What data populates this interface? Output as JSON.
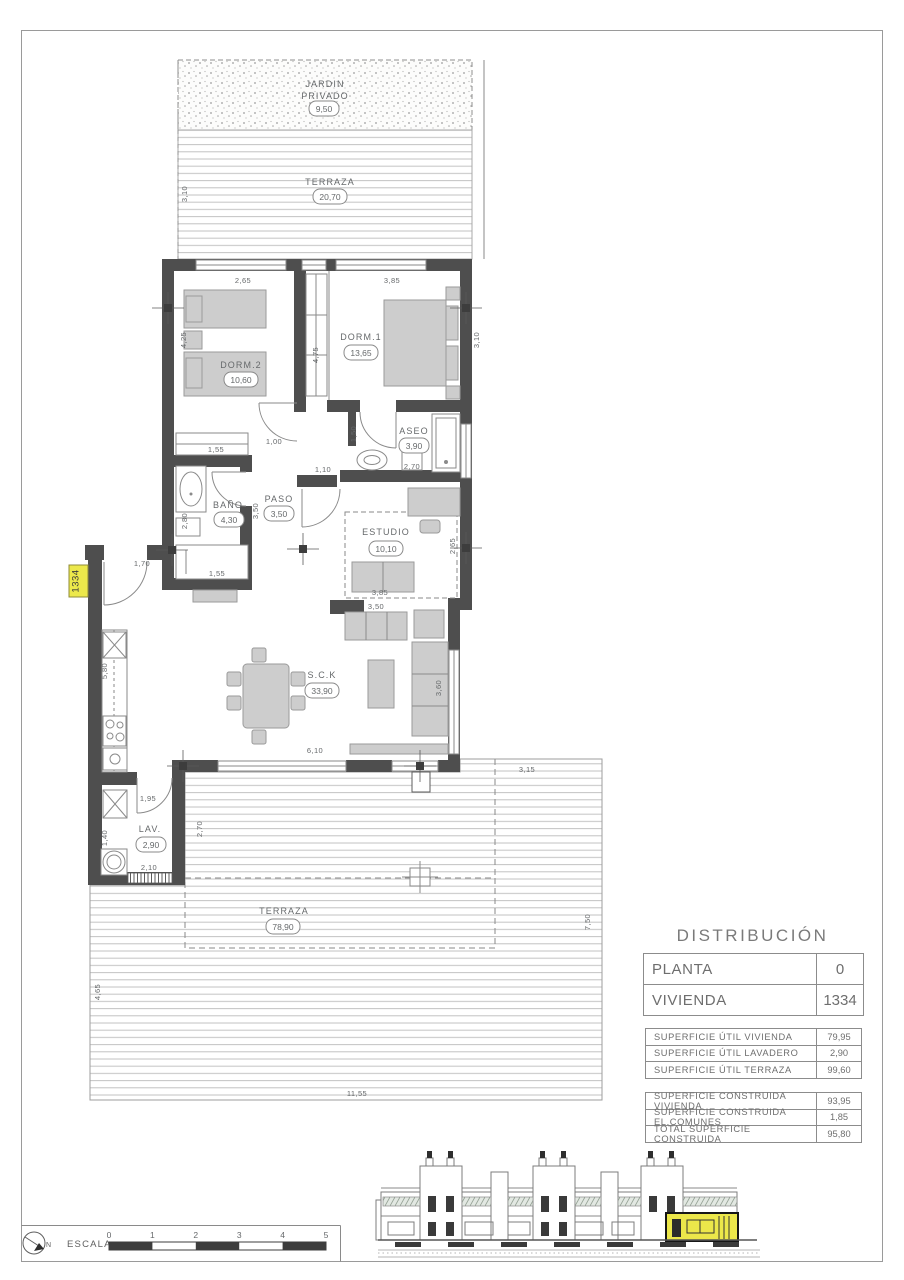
{
  "page": {
    "unit_tag": "1334"
  },
  "plan": {
    "rooms": {
      "jardin": {
        "line1": "JARDIN",
        "line2": "PRIVADO",
        "area": "9,50"
      },
      "terraza_top": {
        "name": "TERRAZA",
        "area": "20,70"
      },
      "dorm1": {
        "name": "DORM.1",
        "area": "13,65"
      },
      "dorm2": {
        "name": "DORM.2",
        "area": "10,60"
      },
      "aseo": {
        "name": "ASEO",
        "area": "3,90"
      },
      "bano": {
        "name": "BAÑO",
        "area": "4,30"
      },
      "paso": {
        "name": "PASO",
        "area": "3,50"
      },
      "estudio": {
        "name": "ESTUDIO",
        "area": "10,10"
      },
      "sck": {
        "name": "S.C.K",
        "area": "33,90"
      },
      "lav": {
        "name": "LAV.",
        "area": "2,90"
      },
      "terraza_main": {
        "name": "TERRAZA",
        "area": "78,90"
      }
    },
    "dims": {
      "terraza_top_height": "3,10",
      "dorm2_width": "2,65",
      "dorm1_width": "3,85",
      "dorm2_height": "4,25",
      "hall_height": "4,75",
      "dorm1_height": "3,10",
      "dorm2_closet": "1,55",
      "paso_top": "1,00",
      "aseo_door": "1,50",
      "aseo_width": "2,70",
      "paso_mid": "1,10",
      "bano_height": "2,80",
      "paso_height": "3,50",
      "bano_closet": "1,55",
      "estudio_height": "2,65",
      "estudio_width": "3,85",
      "sofa_width": "3,50",
      "sofa_depth": "3,60",
      "entry_width": "1,70",
      "kitchen_height": "5,80",
      "sck_width": "6,10",
      "lav_top": "1,95",
      "lav_height": "2,70",
      "lav_bottom": "2,10",
      "lav_left": "1,40",
      "terraza_offset": "3,15",
      "terraza_right": "7,50",
      "terraza_left": "4,65",
      "terraza_width": "11,55"
    }
  },
  "distribucion": {
    "title": "DISTRIBUCIÓN",
    "rows": [
      {
        "label": "PLANTA",
        "value": "0"
      },
      {
        "label": "VIVIENDA",
        "value": "1334"
      }
    ]
  },
  "superficie_util": {
    "rows": [
      {
        "label": "SUPERFICIE ÚTIL VIVIENDA",
        "value": "79,95"
      },
      {
        "label": "SUPERFICIE ÚTIL LAVADERO",
        "value": "2,90"
      },
      {
        "label": "SUPERFICIE ÚTIL TERRAZA",
        "value": "99,60"
      }
    ]
  },
  "superficie_construida": {
    "rows": [
      {
        "label": "SUPERFICIE CONSTRUIDA VIVIENDA",
        "value": "93,95"
      },
      {
        "label": "SUPERFICIE CONSTRUIDA EL.COMUNES",
        "value": "1,85"
      },
      {
        "label": "TOTAL SUPERFICIE CONSTRUIDA",
        "value": "95,80"
      }
    ]
  },
  "escala": {
    "label": "ESCALA :",
    "north": "N",
    "ticks": [
      "0",
      "1",
      "2",
      "3",
      "4",
      "5"
    ]
  }
}
